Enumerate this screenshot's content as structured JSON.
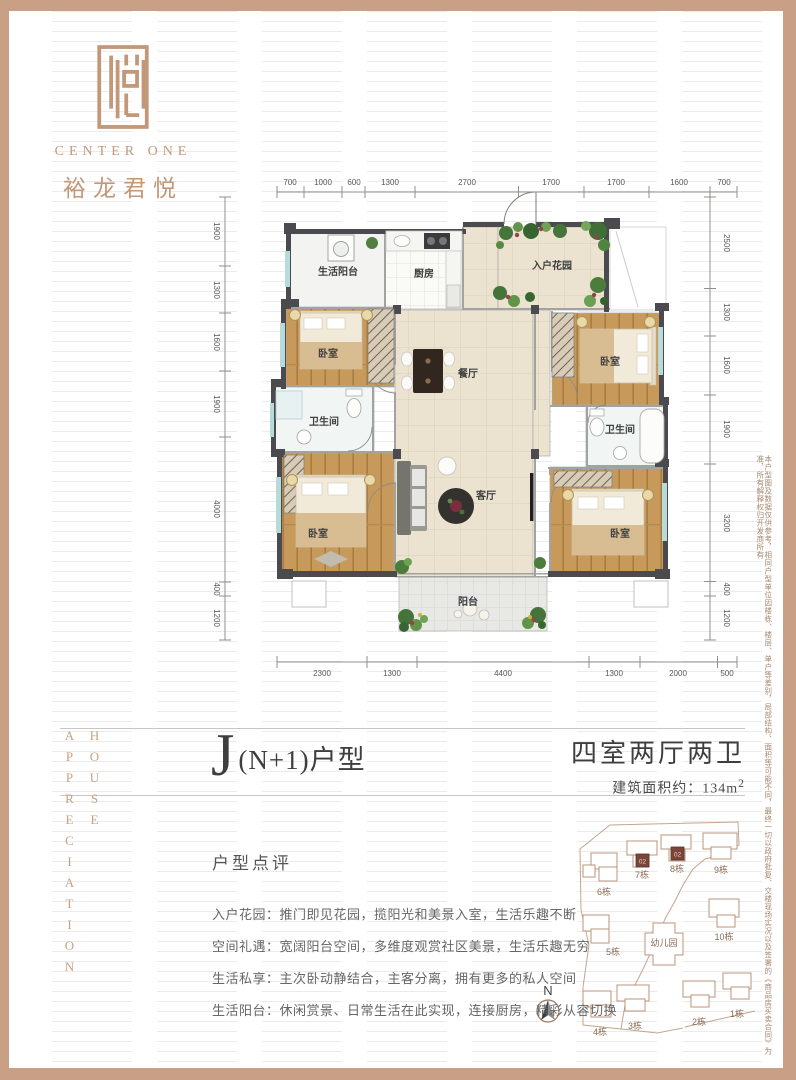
{
  "brand": {
    "name_en": "CENTER ONE",
    "name_cn": "裕龙君悦",
    "accent": "#c39879"
  },
  "side_words": {
    "word_left": "APPRECIATION",
    "word_right": "HOUSE"
  },
  "disclaimer": "本户型图及数据仅供参考，相同户型单位因楼栋、楼层、单户等差别，局部结构、面积等可能不同，最终一切以政府批复、交楼现场实况以及签署的《商品房买卖合同》为准，所有解释权归开发商所有",
  "floorplan": {
    "rooms": {
      "life_balcony": "生活阳台",
      "kitchen": "厨房",
      "entry_garden": "入户花园",
      "bedroom": "卧室",
      "bathroom": "卫生间",
      "dining": "餐厅",
      "living": "客厅",
      "balcony": "阳台"
    },
    "dims_top": [
      "700",
      "1000",
      "600",
      "1300",
      "2700",
      "1700",
      "1700",
      "1600",
      "700"
    ],
    "dims_bottom": [
      "2300",
      "1300",
      "4400",
      "1300",
      "2000",
      "500"
    ],
    "dims_left": [
      "1900",
      "1300",
      "1600",
      "1900",
      "4000",
      "400",
      "1200"
    ],
    "dims_right": [
      "2500",
      "1300",
      "1600",
      "1900",
      "3200",
      "400",
      "1200"
    ]
  },
  "title": {
    "initial": "J",
    "suffix": "(N+1)户型",
    "layout": "四室两厅两卫",
    "area_label": "建筑面积约：",
    "area_value": "134m",
    "area_sup": "2"
  },
  "review": {
    "heading": "户型点评",
    "items": [
      "入户花园：推门即见花园，揽阳光和美景入室，生活乐趣不断",
      "空间礼遇：宽阔阳台空间，多维度观赏社区美景，生活乐趣无穷",
      "生活私享：主次卧动静结合，主客分离，拥有更多的私人空间",
      "生活阳台：休闲赏景、日常生活在此实现，连接厨房，精彩从容切换"
    ]
  },
  "siteplan": {
    "north": "N",
    "kindergarten": "幼儿园",
    "highlight_unit": "02",
    "buildings": [
      {
        "label": "1栋"
      },
      {
        "label": "2栋"
      },
      {
        "label": "3栋"
      },
      {
        "label": "4栋"
      },
      {
        "label": "5栋"
      },
      {
        "label": "6栋"
      },
      {
        "label": "7栋"
      },
      {
        "label": "8栋"
      },
      {
        "label": "9栋"
      },
      {
        "label": "10栋"
      }
    ]
  }
}
